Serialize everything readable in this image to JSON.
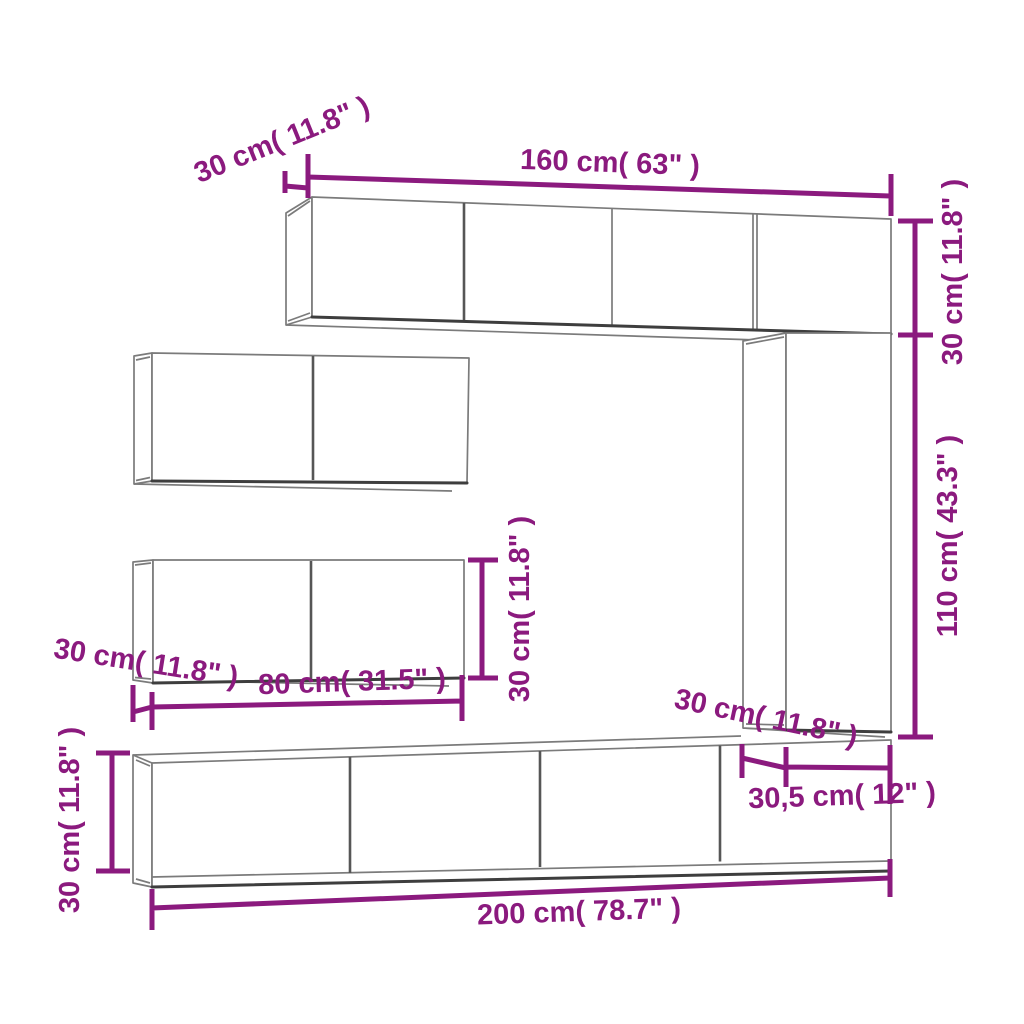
{
  "diagram": {
    "kind": "furniture-dimension-diagram",
    "subject": "TV wall cabinet set",
    "colors": {
      "dimension_accent": "#8B1A7E",
      "outline_gray": "#7b7b7b",
      "outline_dark": "#3e3e3e",
      "divider_gray": "#565656",
      "background": "#ffffff"
    },
    "dimensions": [
      {
        "id": "top-cabinet-depth",
        "text": "30 cm( 11.8\" )"
      },
      {
        "id": "top-cabinet-width",
        "text": "160 cm( 63\" )"
      },
      {
        "id": "top-right-height",
        "text": "30 cm( 11.8\" )"
      },
      {
        "id": "right-column-height",
        "text": "110 cm( 43.3\" )"
      },
      {
        "id": "mid-cabinet-depth",
        "text": "30 cm( 11.8\" )"
      },
      {
        "id": "mid-cabinet-width",
        "text": "80 cm( 31.5\" )"
      },
      {
        "id": "mid-cabinet-height",
        "text": "30 cm( 11.8\" )"
      },
      {
        "id": "column-depth",
        "text": "30 cm( 11.8\" )"
      },
      {
        "id": "column-width",
        "text": "30,5 cm( 12\" )"
      },
      {
        "id": "bottom-cabinet-height",
        "text": "30 cm( 11.8\" )"
      },
      {
        "id": "bottom-cabinet-width",
        "text": "200 cm( 78.7\" )"
      }
    ]
  }
}
